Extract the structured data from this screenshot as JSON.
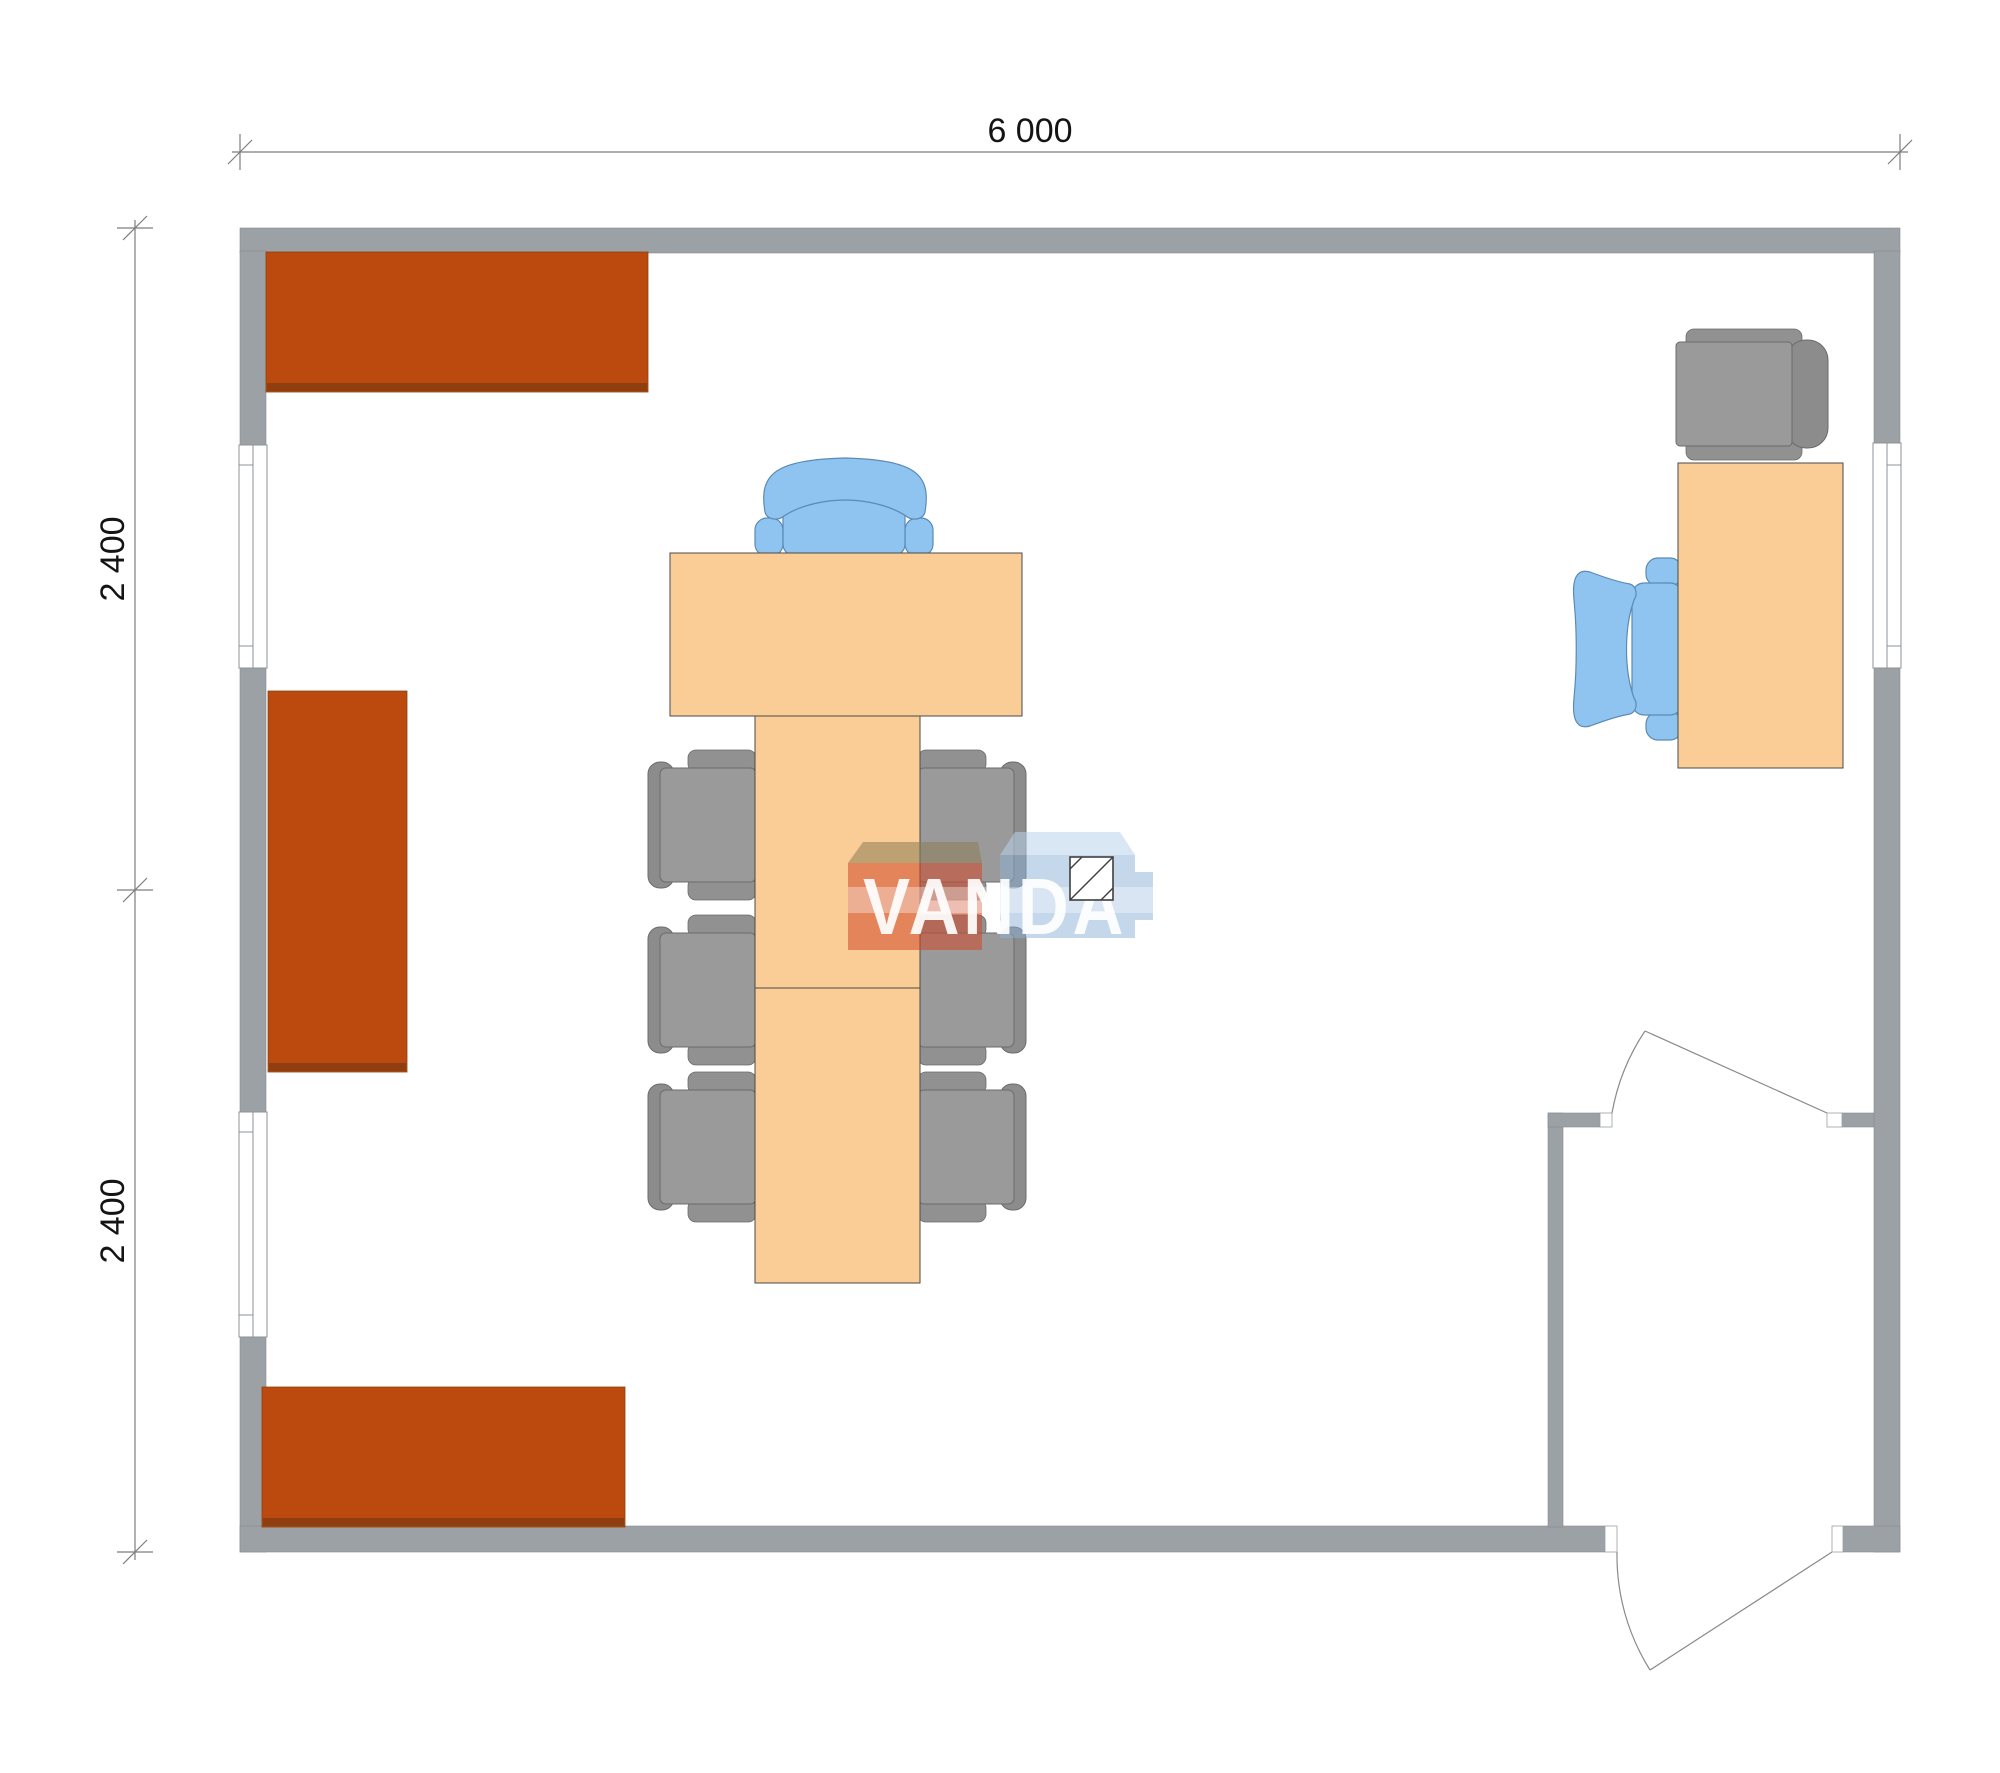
{
  "plan": {
    "width_dimension_label": "6 000",
    "left_upper_dimension_label": "2 400",
    "left_lower_dimension_label": "2 400"
  },
  "watermark": {
    "text": "VANDA"
  },
  "palette": {
    "wall_gray": "#9CA1A5",
    "cabinet_orange": "#BC4A0E",
    "cabinet_shadow": "#8F3E10",
    "table_peach": "#FACD96",
    "chair_gray": "#9A9A9A",
    "chair_gray_back": "#8C8C8C",
    "chair_blue": "#8FC4F0",
    "door_line": "#8A8A8A",
    "dimension_line": "#7D7D7D",
    "dimension_text": "#141414",
    "watermark_red": "rgba(210,73,42,0.55)",
    "watermark_khaki": "rgba(140,125,85,0.55)",
    "watermark_blue": "rgba(140,175,215,0.50)",
    "watermark_text_color": "rgba(255,255,255,0.92)"
  },
  "contents": {
    "rooms": [
      "main-office",
      "entrance-vestibule"
    ],
    "furniture": [
      {
        "name": "wall-shelf-top-left",
        "count": 1
      },
      {
        "name": "wall-cabinet-middle-left",
        "count": 1
      },
      {
        "name": "wall-shelf-bottom-left",
        "count": 1
      },
      {
        "name": "meeting-table-head",
        "count": 1
      },
      {
        "name": "meeting-table-long",
        "count": 1
      },
      {
        "name": "executive-chair-blue",
        "count": 1
      },
      {
        "name": "side-chair-gray",
        "count": 6
      },
      {
        "name": "office-desk",
        "count": 1
      },
      {
        "name": "desk-chair-blue",
        "count": 1
      },
      {
        "name": "armchair-gray",
        "count": 1
      },
      {
        "name": "window",
        "count": 3
      },
      {
        "name": "entrance-door",
        "count": 2
      },
      {
        "name": "ceiling-light-fixture",
        "count": 1
      }
    ]
  }
}
